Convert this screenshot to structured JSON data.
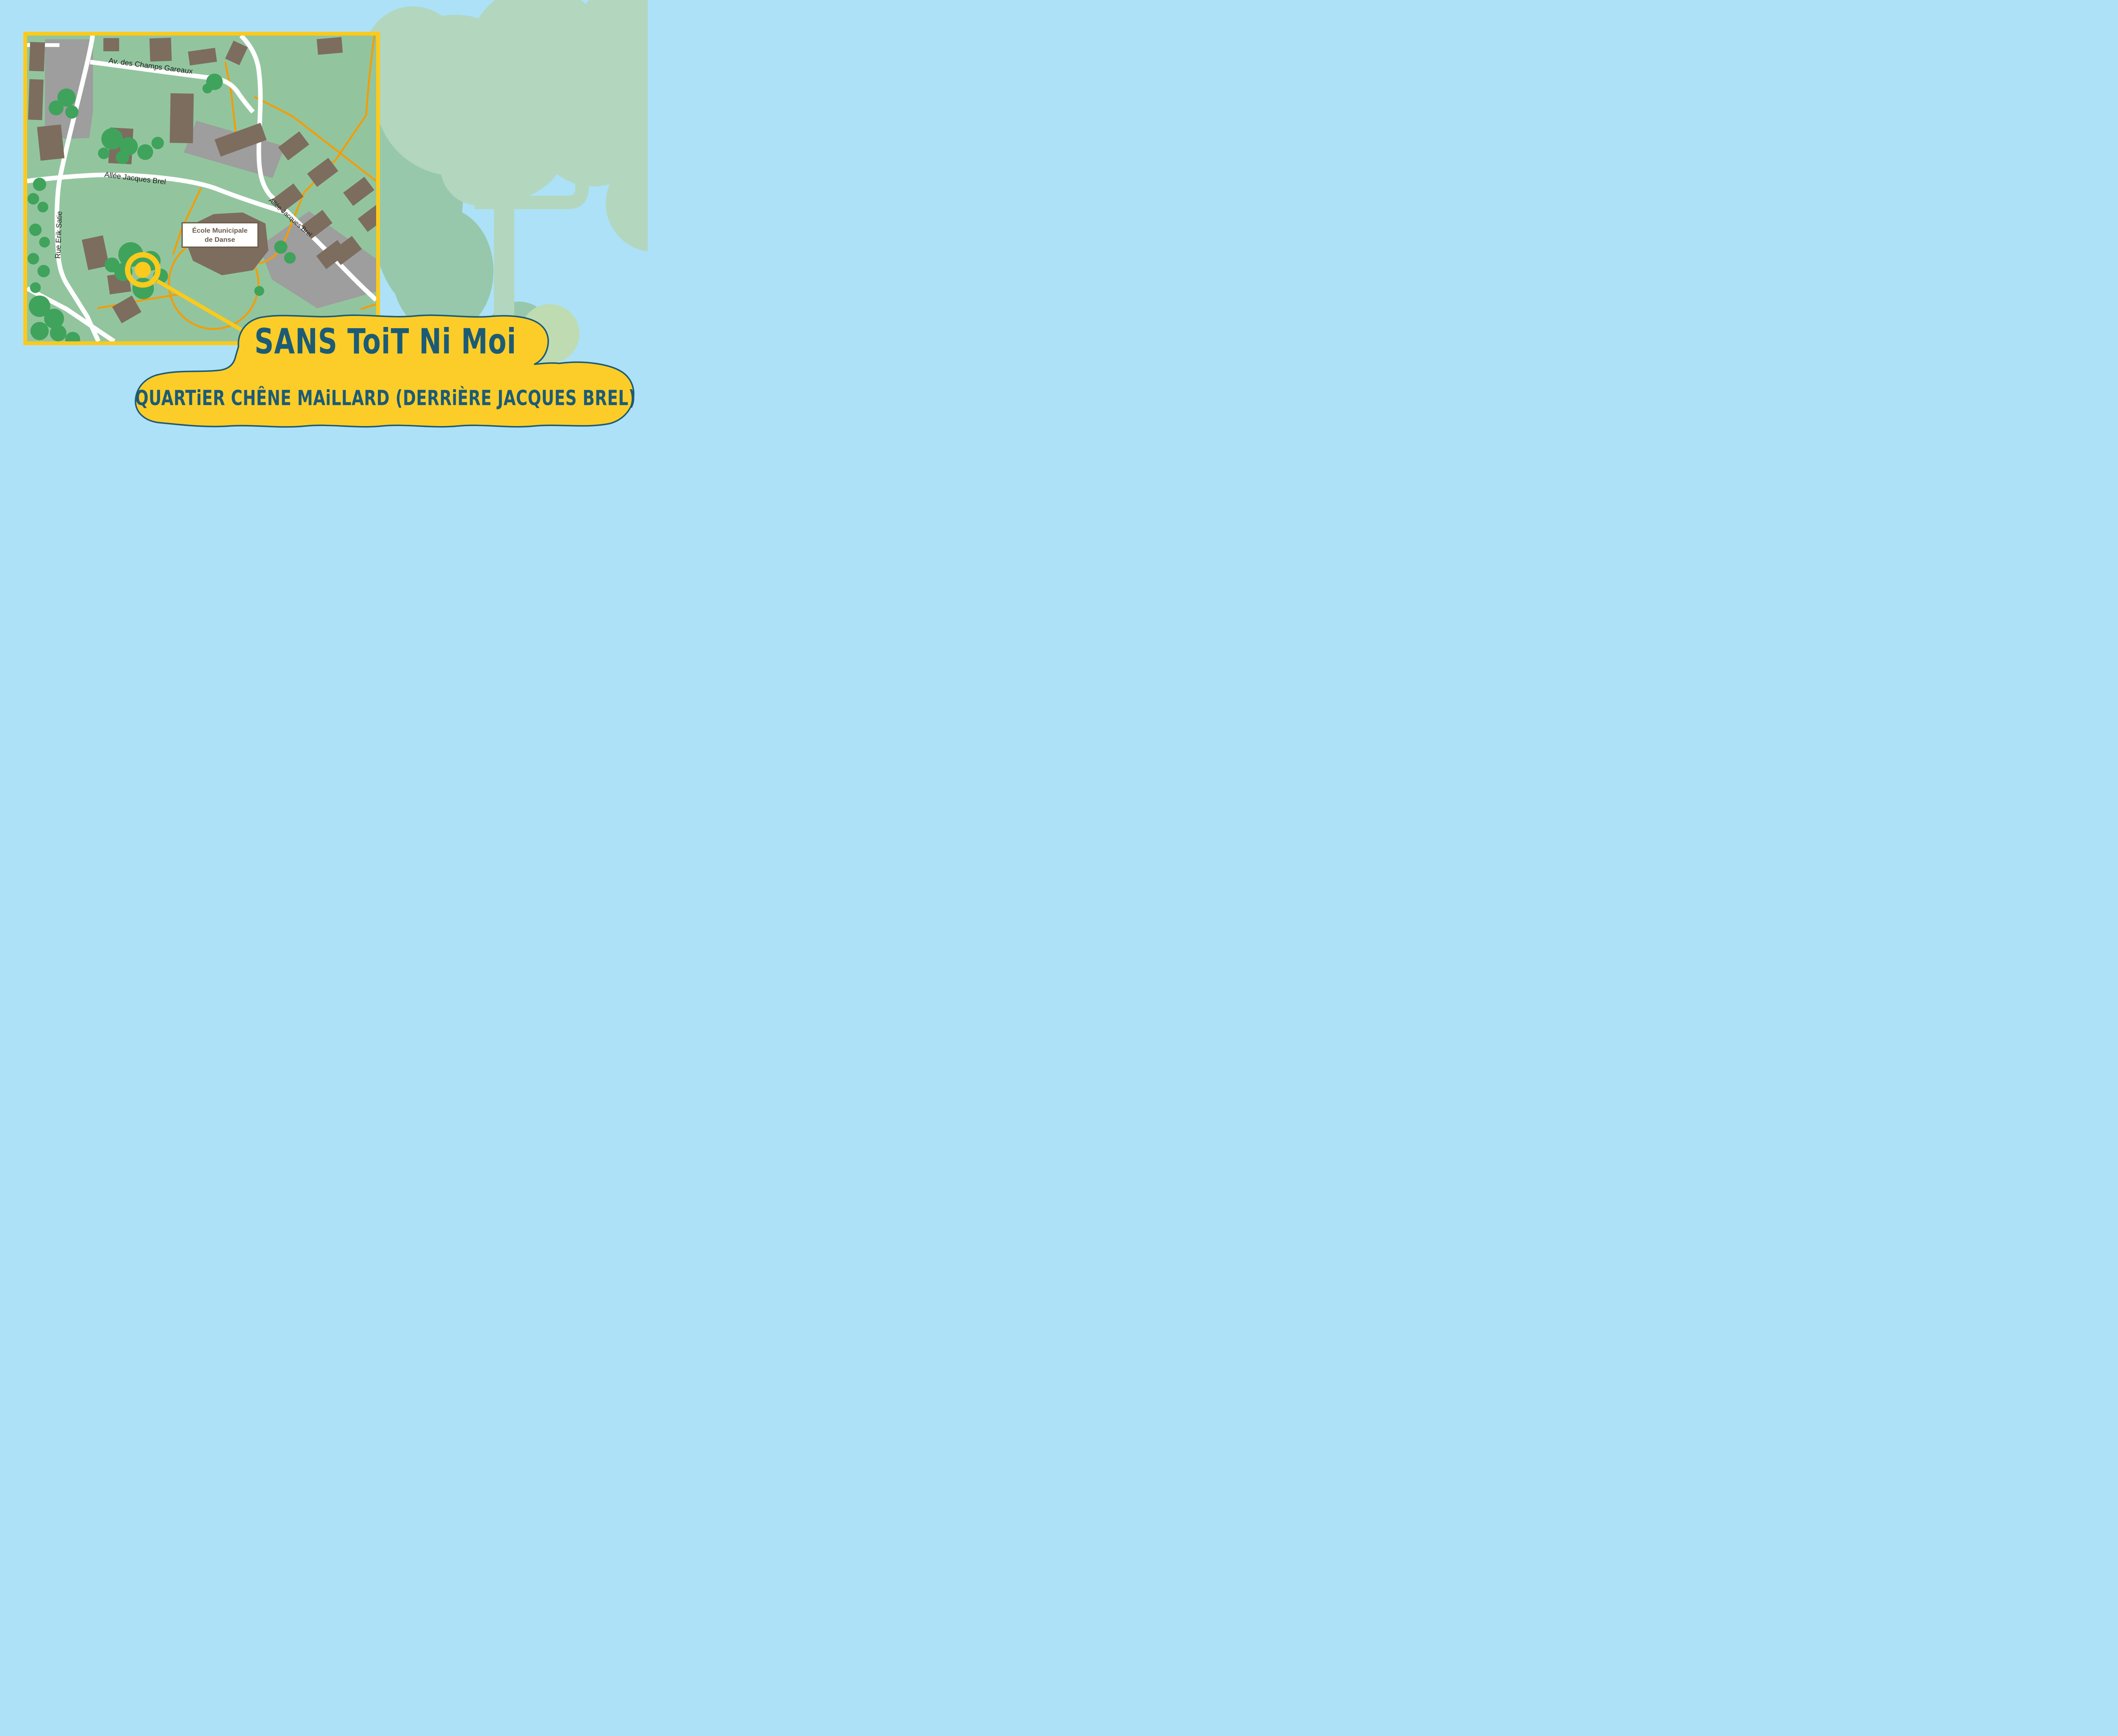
{
  "page": {
    "background_color": "#ade1f7"
  },
  "banner": {
    "title": "SANS ToiT Ni Moi",
    "subtitle": "QUARTiER CHÊNE MAiLLARD (DERRiÈRE JACQUES BREL)",
    "fill_color": "#fccd28",
    "outline_color": "#1c5b76",
    "text_color": "#1c5b76"
  },
  "map": {
    "labels": {
      "av_champs": "Av. des Champs Gareaux",
      "allee_brel": "Allée Jacques Brel",
      "allee_brel_diag": "Allée Jacques Brel",
      "rue_satie": "Rue Erik Satie"
    },
    "poi": {
      "line1": "École Municipale",
      "line2": "de Danse"
    },
    "marker": {
      "type": "target-ring",
      "color": "#fcca1c"
    },
    "colors": {
      "ground": "#92c59e",
      "road": "#ffffff",
      "footpath": "#f59c00",
      "building": "#7d6d5e",
      "parking": "#9e9e9e",
      "tree": "#3fa35c",
      "border": "#fcca1c",
      "poi_text": "#6b5b4b",
      "street_text": "#1b1b1b"
    }
  },
  "background_tree": {
    "canopy_color": "#b3d6bf",
    "shadow_color": "#97c8ac",
    "bush_color": "#bedbb2"
  }
}
